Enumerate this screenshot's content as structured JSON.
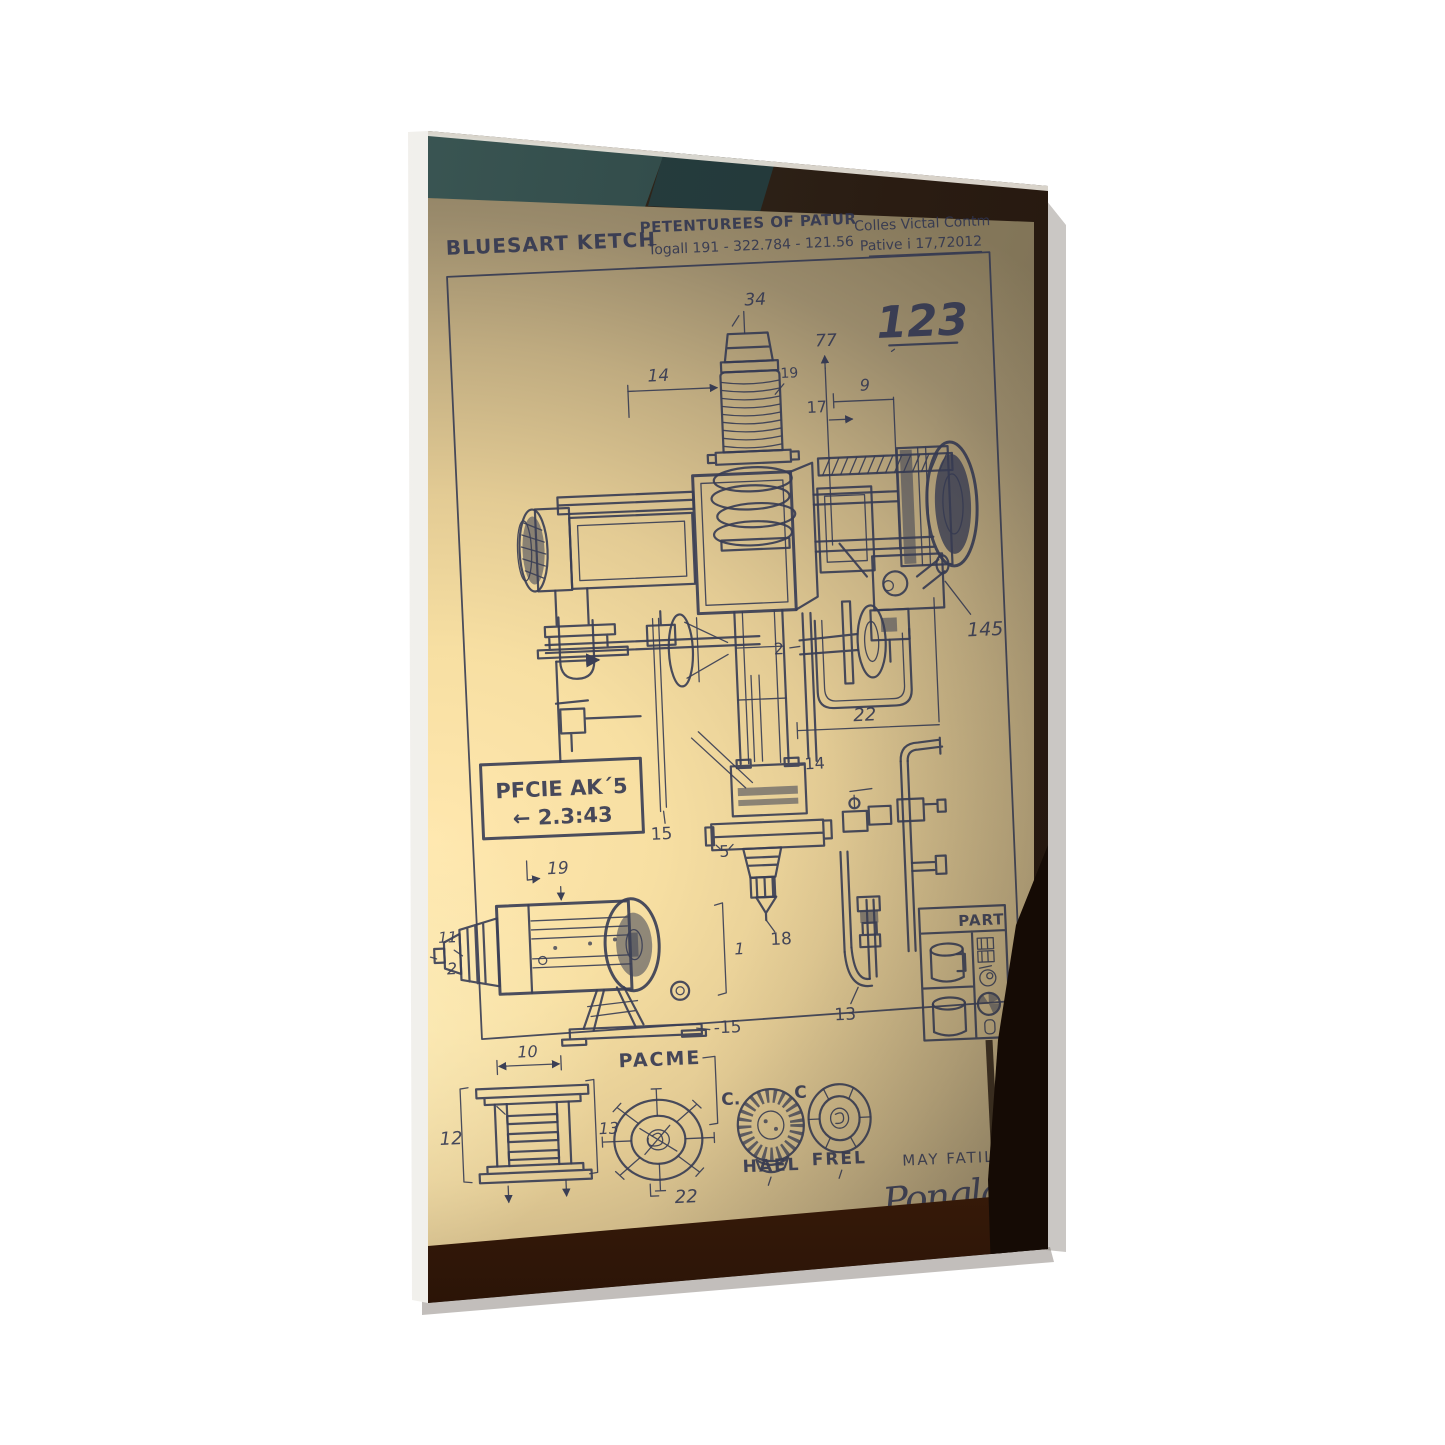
{
  "scene": {
    "background": "#ffffff",
    "ink": "#2e3450",
    "paper_glow": "#ffe7ae",
    "paper_shadow": "#998a6b",
    "wood": "#8a4414",
    "glass": "#3d5a57"
  },
  "sheet": {
    "brand": "BLUESART KETCH",
    "title_line1": "PETENTUREES OF PATUR",
    "title_line2": "Togall 191  - 322.784 - 121.56",
    "ref_line1": "Colles Victal Contm",
    "ref_line2": "Pative i 17,72012",
    "page_number": "123",
    "note_line1": "PFCIE AK´5",
    "note_line2": "← 2.3:43",
    "table_header": "PART",
    "caption_pacme": "PACME",
    "caption_c_left": "C.",
    "caption_c_right": "C",
    "caption_hael": "HAEL",
    "caption_frel": "FREL",
    "author": "MAY FATILLS",
    "signature": "Ponglad Int",
    "callouts": {
      "cap": "34",
      "dim_width": "14",
      "spring": "19",
      "rod": "77",
      "feed": "17",
      "dim_right": "9",
      "column": "2",
      "bracket": "145",
      "dim_base": "22",
      "gauge": "15",
      "chuck_hat": "5",
      "quill": "-14",
      "bit_tip": "18",
      "hose": "13",
      "motor_top": "19",
      "motor_nose": "11",
      "motor_tip": "2",
      "motor_span": "1",
      "motor_base": "-15",
      "frame_width": "10",
      "frame_height": "12",
      "frame_depth": "13",
      "wheel": "22"
    }
  }
}
